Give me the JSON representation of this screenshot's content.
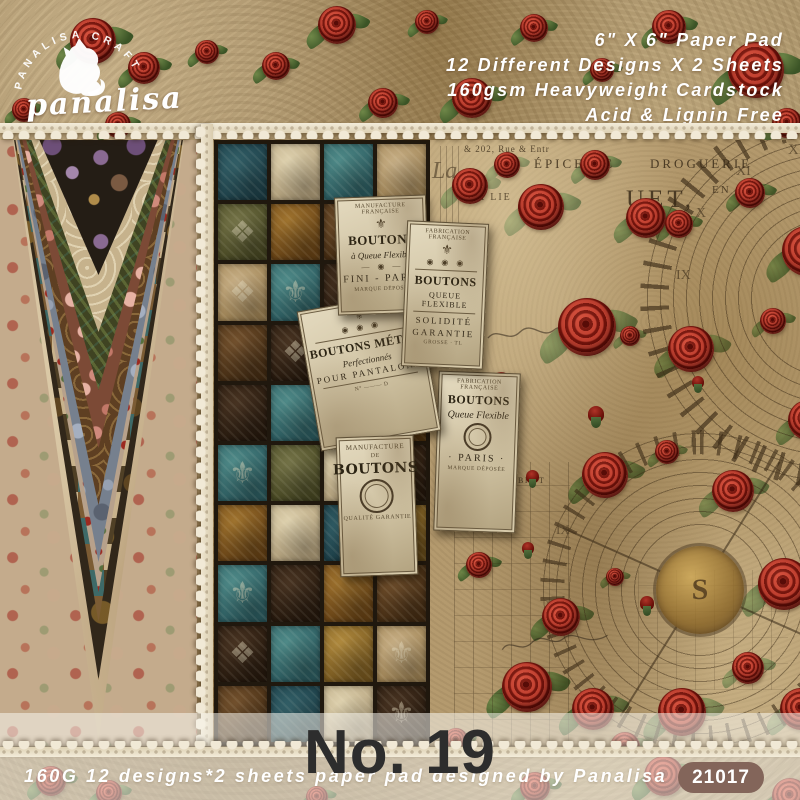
{
  "brand": {
    "arc_text": "PANALISA CRAFT",
    "script_text": "panalisa"
  },
  "header": {
    "product_info": [
      "6\" X 6\" Paper Pad",
      "12 Different Designs X 2 Sheets",
      "160gsm Heavyweight Cardstock",
      "Acid & Lignin Free"
    ]
  },
  "labels": {
    "flexible": {
      "header": "MANUFACTURE FRANÇAISE",
      "crest": "⚜",
      "title": "BOUTONS",
      "subtitle": "à Queue Flexible",
      "ornament": "— ◉ —",
      "line": "FINI - PARIS",
      "footer": "MARQUE DÉPOSÉE"
    },
    "solidite": {
      "header": "FABRICATION FRANÇAISE",
      "crest": "⚜",
      "medallions": "◉ ◉ ◉",
      "title": "BOUTONS",
      "subtitle": "QUEUE FLEXIBLE",
      "line1": "SOLIDITÉ",
      "line2": "GARANTIE",
      "footer": "GROSSE · TL"
    },
    "metal": {
      "crest": "⚜",
      "medallions": "◉ ◉ ◉",
      "title": "BOUTONS MÉTAL",
      "subtitle": "Perfectionnés",
      "line": "POUR PANTALONS",
      "footer": "N°  ———  D"
    },
    "paris": {
      "header": "FABRICATION FRANÇAISE",
      "title": "BOUTONS",
      "subtitle": "Queue Flexible",
      "line": "· PARIS ·",
      "footer": "MARQUE DÉPOSÉE"
    },
    "manufacture": {
      "header": "MANUFACTURE",
      "mid": "DE",
      "title": "BOUTONS",
      "footer": "QUALITÉ GARANTIE"
    }
  },
  "collage": {
    "ephemera": {
      "t1": "& 202, Rue & Entr",
      "t2": "ÉPICERIE",
      "t3": "DROGUERIE",
      "t4": "EN",
      "t5": "UET,",
      "t6": "à LA LIE",
      "t7": "BRUT",
      "t8": "F°",
      "t9": "La"
    }
  },
  "footer": {
    "number": "No. 19",
    "tagline": "160G 12 designs*2 sheets paper pad designed by Panalisa",
    "sku": "21017"
  }
}
